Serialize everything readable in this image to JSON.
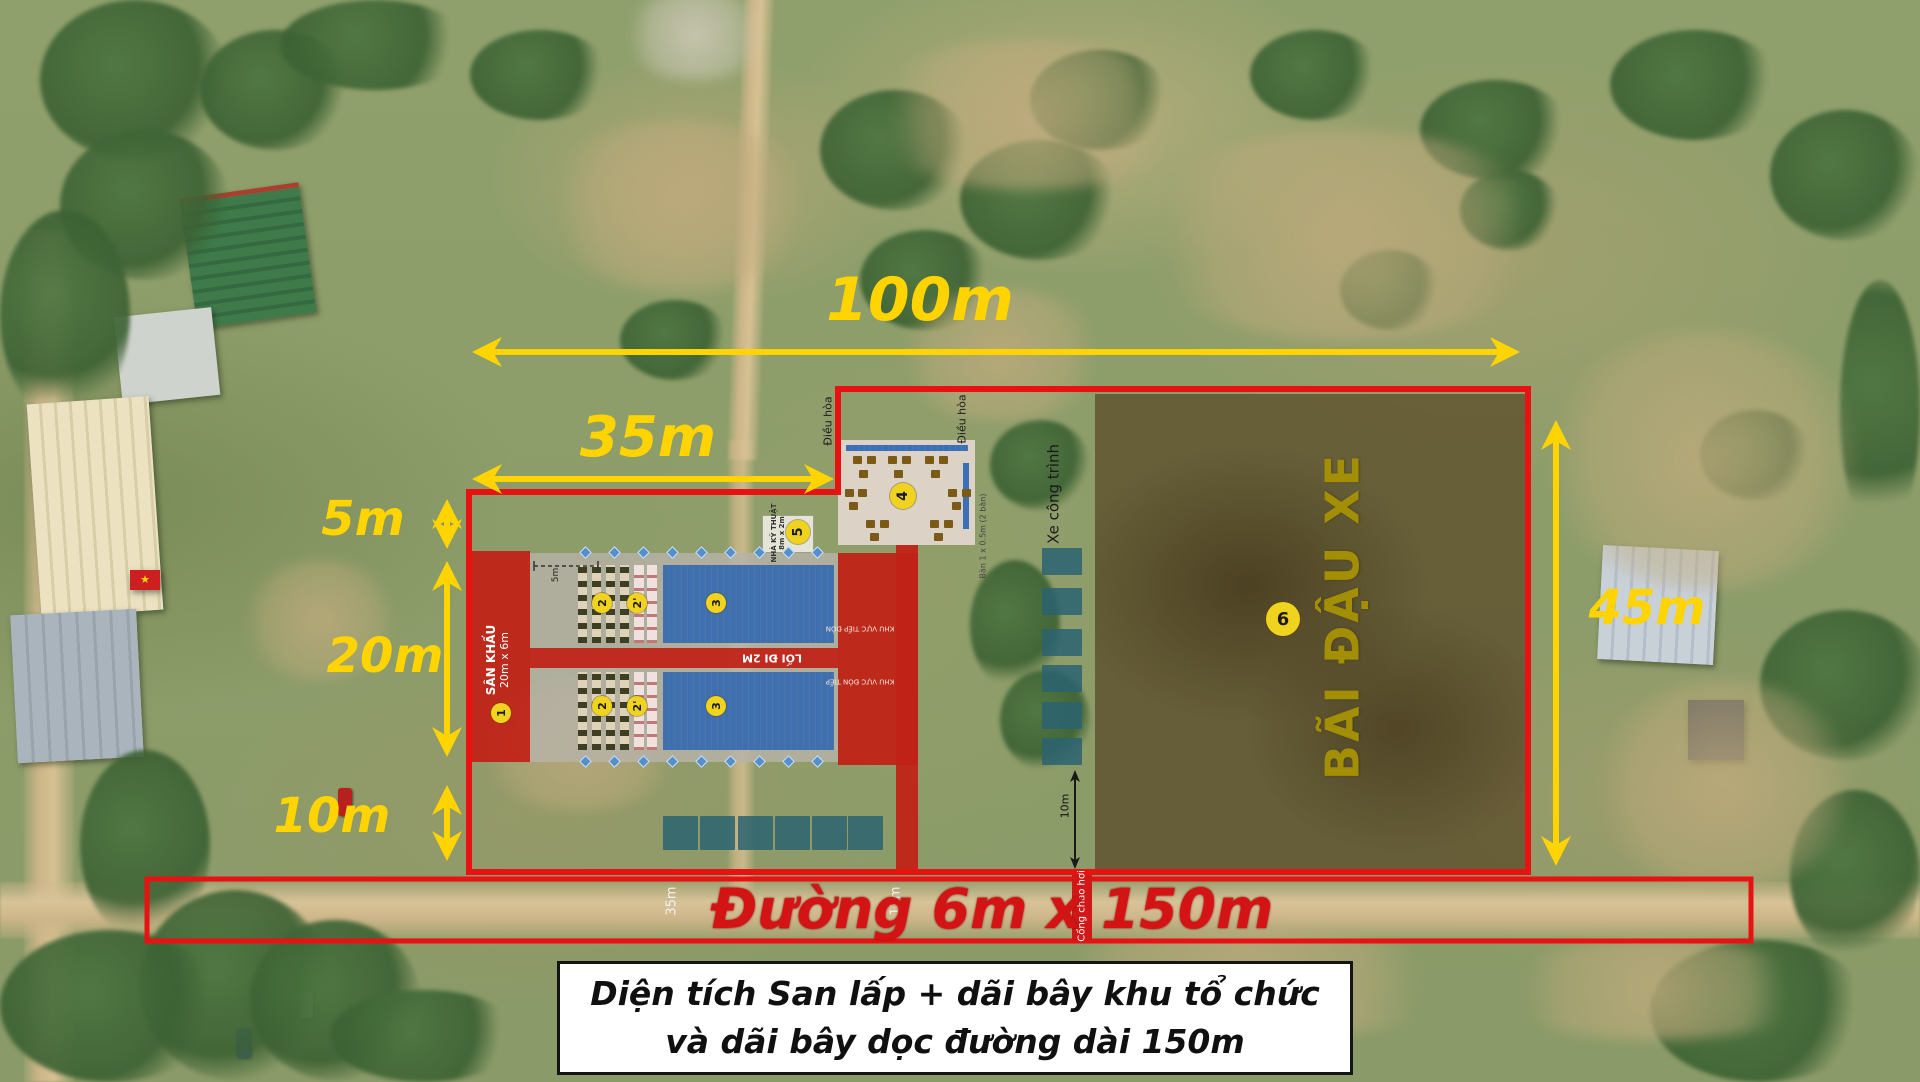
{
  "colors": {
    "accent_yellow": "#ffd400",
    "boundary_red": "#e81212",
    "road_red": "#d41414",
    "parking_gold": "#a38f06"
  },
  "dimensions": {
    "width_total": "100m",
    "width_inner": "35m",
    "h_5m": "5m",
    "h_20m": "20m",
    "h_10m": "10m",
    "height_right": "45m",
    "depth_10m": "10m",
    "seating_5m": "5m",
    "road_35m": "35m",
    "road_13m": "13m"
  },
  "zones": {
    "stage": {
      "number": "1",
      "name": "SÂN KHẤU",
      "size": "20m x 6m"
    },
    "seating_left": {
      "number": "2"
    },
    "seating_left_prime": {
      "number": "2'"
    },
    "seating_main": {
      "number": "3"
    },
    "reception_platform": {
      "number": "4",
      "table_note": "Bàn 1 x 0.5m (2 bàn)"
    },
    "technical_house": {
      "number": "5",
      "name": "NHÀ KỸ THUẬT",
      "size": "8m x 2m"
    },
    "parking": {
      "number": "6",
      "name": "BÃI ĐẬU XE"
    }
  },
  "annotations": {
    "air_conditioner_left": "Điều hòa",
    "air_conditioner_right": "Điều hòa",
    "construction_vehicles": "Xe công trình",
    "aisle": "LỐI ĐI 2M",
    "reception_zone_upper": "KHU VỰC TIẾP ĐÓN",
    "reception_zone_lower": "KHU VỰC ĐÓN TIẾP",
    "inflatable_gate": "Cổng chào hơi"
  },
  "road": {
    "label": "Đường 6m x 150m"
  },
  "caption": {
    "line1": "Diện tích San lấp + dãi bây khu tổ chức",
    "line2": "và dãi bây dọc đường dài 150m"
  }
}
